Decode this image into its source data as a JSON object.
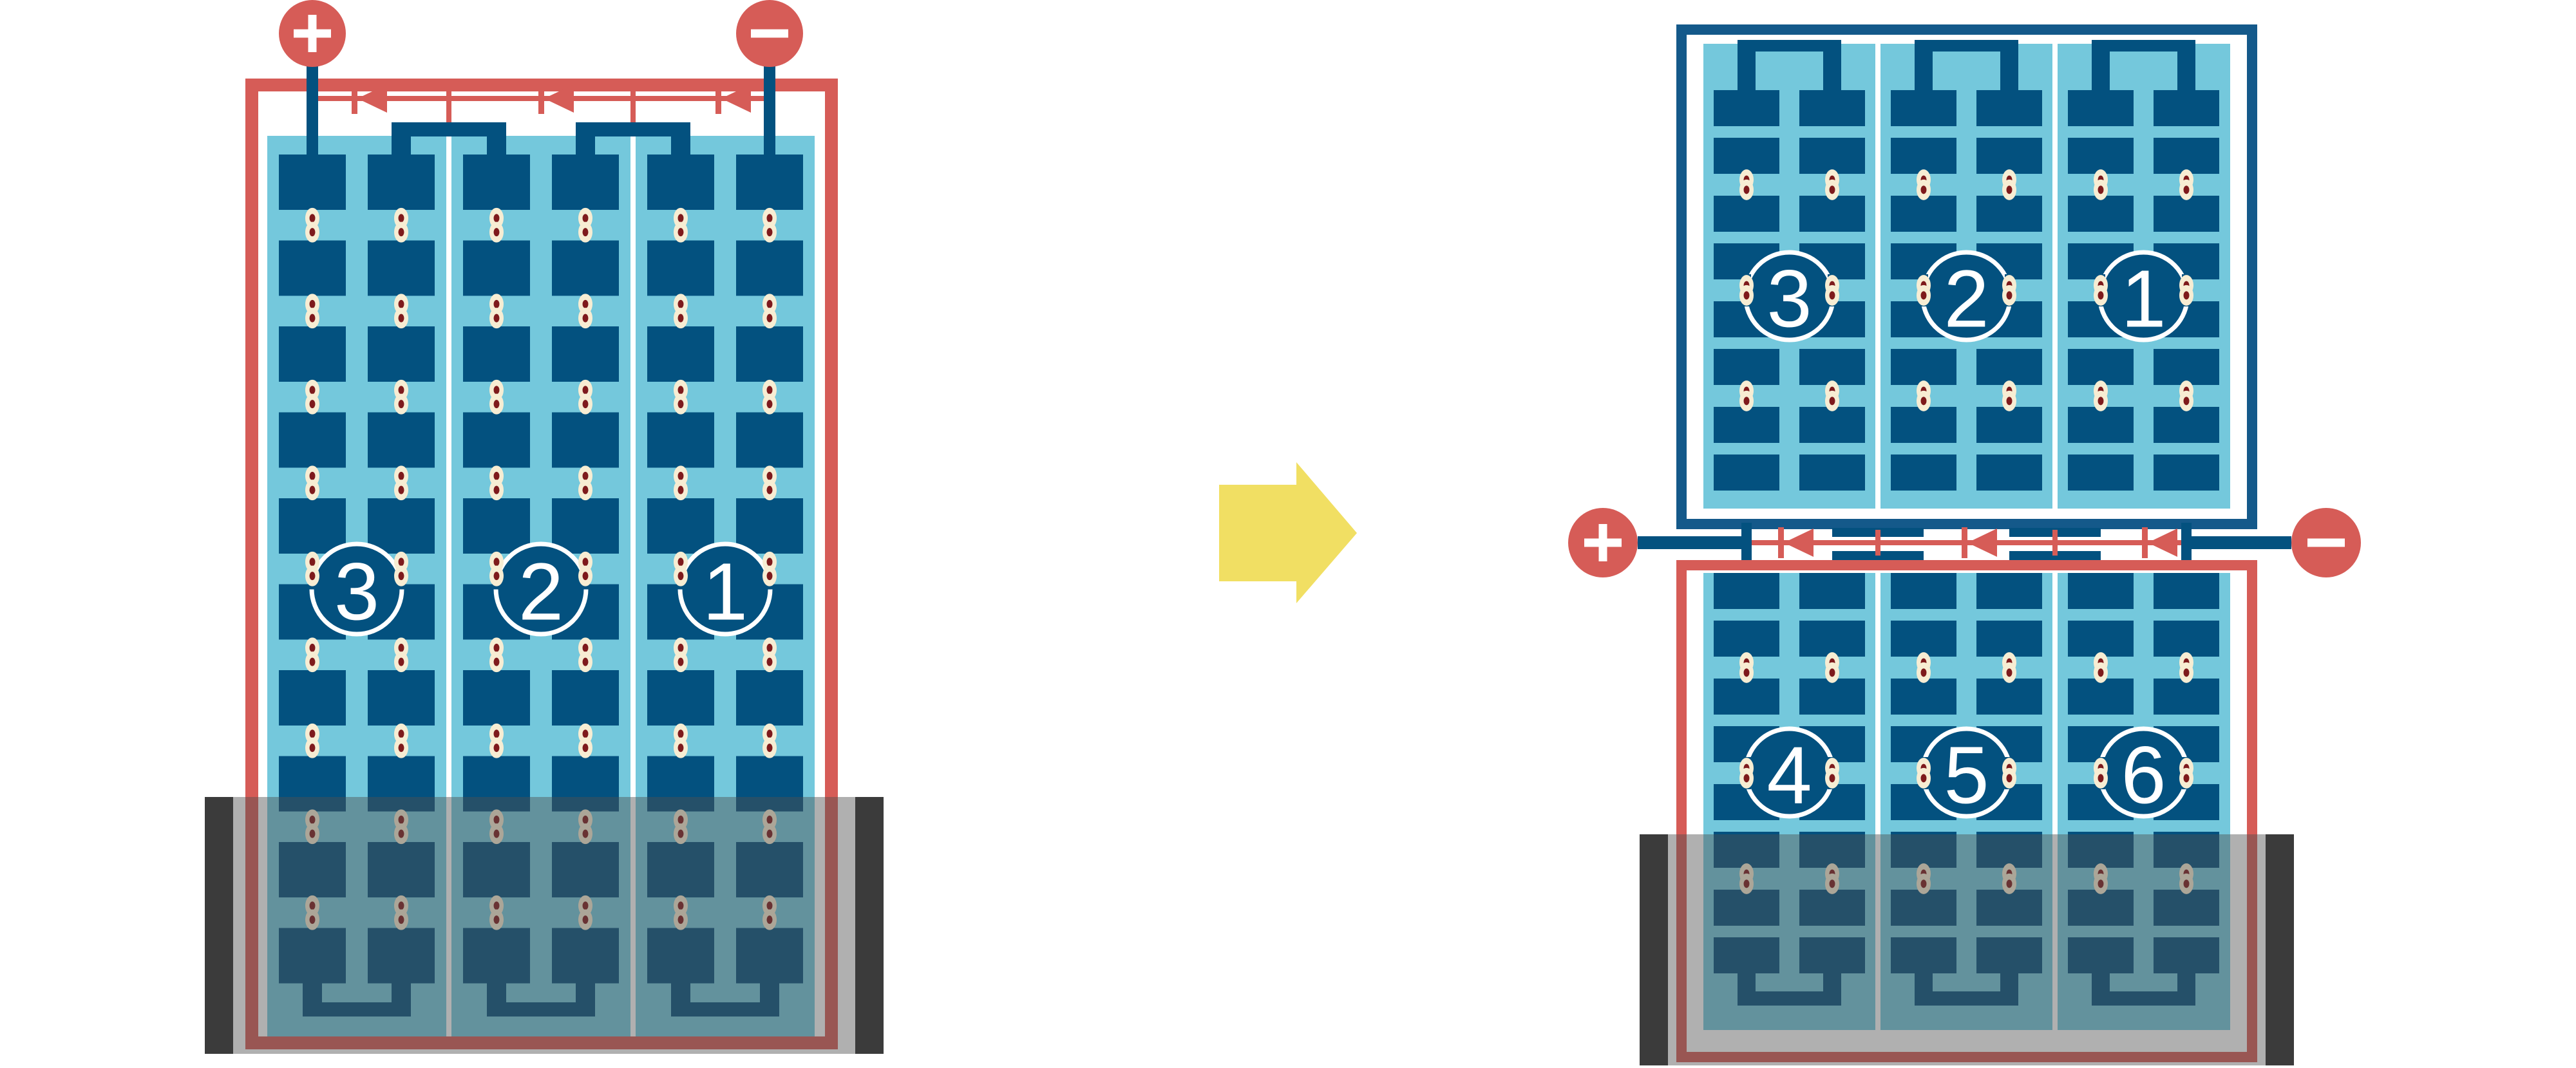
{
  "colors": {
    "red": "#D65C57",
    "frame_blue": "#14598A",
    "dark_blue": "#03517F",
    "light_blue": "#74C8DC",
    "cream": "#F7EDD3",
    "dot_red": "#7E1A1C",
    "yellow": "#F1DF63",
    "shade": "rgba(80,80,80,0.45)",
    "shade_bar": "#3B3B3B",
    "white": "#FFFFFF"
  },
  "arrow": {
    "direction": "right",
    "color_key": "yellow"
  },
  "left_module": {
    "frame_color_key": "red",
    "terminals": {
      "positive": "+",
      "negative": "−"
    },
    "strings": [
      {
        "label": "3"
      },
      {
        "label": "2"
      },
      {
        "label": "1"
      }
    ],
    "bypass_diode_count": 3,
    "cell_rows": 10,
    "columns_per_string": 2,
    "shaded_bottom": true
  },
  "right_module": {
    "terminals": {
      "positive": "+",
      "negative": "−"
    },
    "top_half": {
      "frame_color_key": "frame_blue",
      "strings": [
        {
          "label": "3"
        },
        {
          "label": "2"
        },
        {
          "label": "1"
        }
      ],
      "cell_rows": 8
    },
    "bottom_half": {
      "frame_color_key": "red",
      "strings": [
        {
          "label": "4"
        },
        {
          "label": "5"
        },
        {
          "label": "6"
        }
      ],
      "cell_rows": 8
    },
    "bypass_diode_count": 3,
    "shaded_bottom": true
  }
}
